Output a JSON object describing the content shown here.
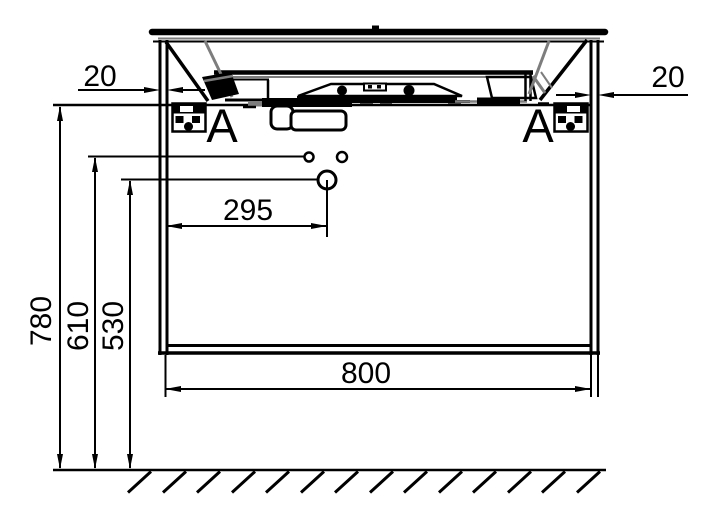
{
  "drawing": {
    "object": "vanity-cabinet-with-washbasin-front-section",
    "section_markers": {
      "left": "A",
      "right": "A"
    },
    "dims": {
      "panel_left": "20",
      "panel_right": "20",
      "height_total": "780",
      "height_faucet_holes": "610",
      "height_drain_hole": "530",
      "drain_offset": "295",
      "width": "800"
    },
    "colors": {
      "line": "#000000",
      "secondary": "#7d7d7d",
      "background": "#ffffff"
    }
  }
}
